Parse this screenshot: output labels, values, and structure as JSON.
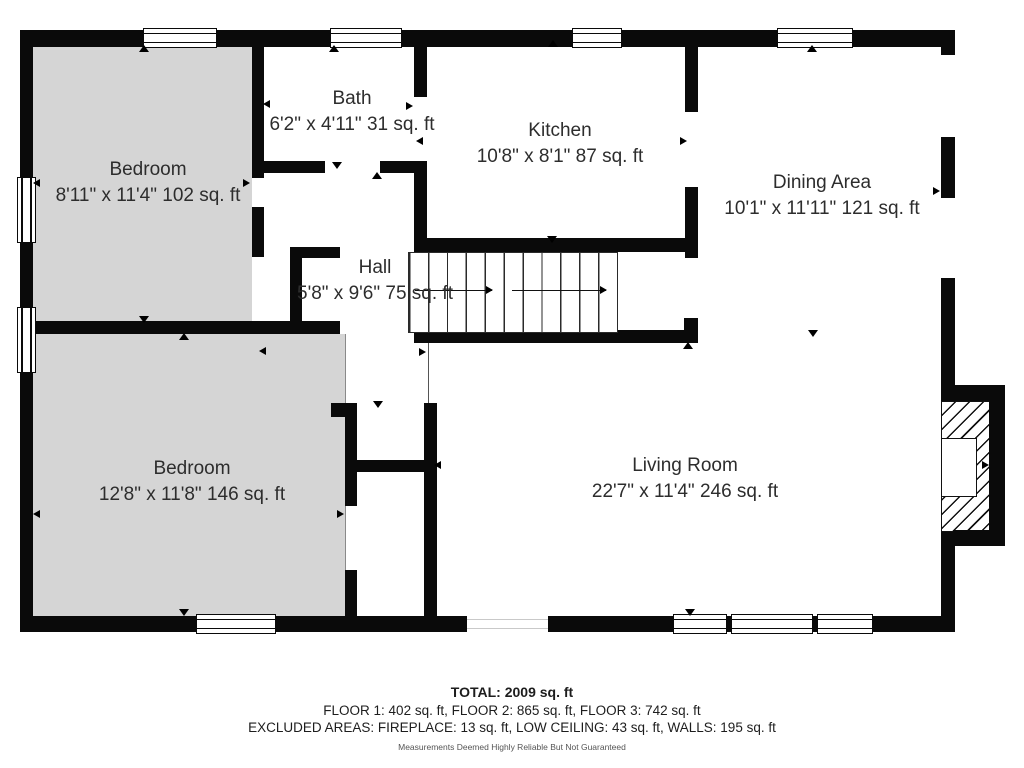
{
  "plan": {
    "rooms": [
      {
        "id": "bedroom-1",
        "name": "Bedroom",
        "dims": "8'11\" x 11'4\" 102 sq. ft"
      },
      {
        "id": "bath",
        "name": "Bath",
        "dims": "6'2\" x 4'11\" 31 sq. ft"
      },
      {
        "id": "kitchen",
        "name": "Kitchen",
        "dims": "10'8\" x 8'1\" 87 sq. ft"
      },
      {
        "id": "dining-area",
        "name": "Dining Area",
        "dims": "10'1\" x 11'11\" 121 sq. ft"
      },
      {
        "id": "hall",
        "name": "Hall",
        "dims": "5'8\" x 9'6\" 75 sq. ft"
      },
      {
        "id": "living-room",
        "name": "Living Room",
        "dims": "22'7\" x 11'4\" 246 sq. ft"
      },
      {
        "id": "bedroom-2",
        "name": "Bedroom",
        "dims": "12'8\" x 11'8\" 146 sq. ft"
      }
    ],
    "summary": {
      "total": "TOTAL: 2009 sq. ft",
      "floors": "FLOOR 1: 402 sq. ft, FLOOR 2: 865 sq. ft, FLOOR 3: 742 sq. ft",
      "excluded": "EXCLUDED AREAS: FIREPLACE: 13 sq. ft, LOW CEILING: 43 sq. ft, WALLS: 195 sq. ft",
      "disclaimer": "Measurements Deemed Highly Reliable But Not Guaranteed"
    },
    "colors": {
      "wall": "#0a0a0a",
      "bedroom_fill": "#d5d5d5",
      "text": "#2d2d2d"
    }
  }
}
